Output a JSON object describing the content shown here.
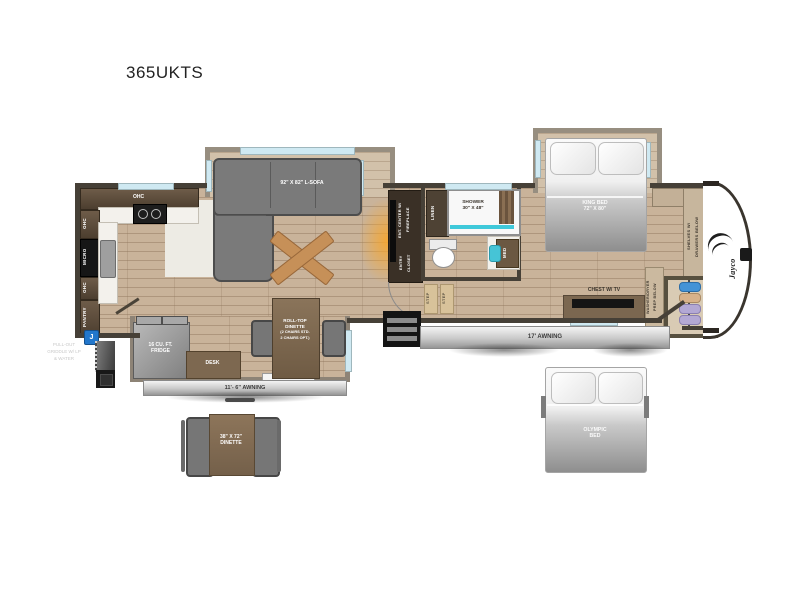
{
  "page": {
    "title": "365UKTS"
  },
  "floorplan": {
    "kitchen": {
      "ohc_top": "OHC",
      "ohc_upper": "OHC",
      "micro": "MICRO",
      "ohc_lower": "OHC",
      "pantry": "PANTRY"
    },
    "living": {
      "sofa": "92\" X 82\" L-SOFA",
      "ent_center_line1": "ENT. CENTER W/",
      "ent_center_line2": "FIREPLACE",
      "entry_closet_line1": "ENTRY",
      "entry_closet_line2": "CLOSET"
    },
    "bath": {
      "linen": "LINEN",
      "shower_line1": "SHOWER",
      "shower_line2": "30\" X 48\"",
      "med": "MED",
      "step": "STEP"
    },
    "bedroom": {
      "king_bed_line1": "KING BED",
      "king_bed_line2": "72\" X 80\"",
      "chest": "CHEST W/ TV",
      "shelves_line1": "SHELVES W/",
      "shelves_line2": "DRAWERS BELOW",
      "washer_line1": "WASHER/DRYER",
      "washer_line2": "PREP BELOW"
    },
    "slide_dinette": {
      "fridge_line1": "16 CU. FT.",
      "fridge_line2": "FRIDGE",
      "desk": "DESK",
      "rolltop_line1": "ROLL-TOP",
      "rolltop_line2": "DINETTE",
      "rolltop_note1": "(2 CHAIRS STD.",
      "rolltop_note2": "2 CHAIRS OPT.)"
    },
    "exterior": {
      "awning_main": "17' AWNING",
      "awning_slide": "11'- 6\" AWNING",
      "griddle_note_line1": "PULL-OUT",
      "griddle_note_line2": "GRIDDLE W/ LP",
      "griddle_note_line3": "& WATER",
      "j_marker": "J",
      "brand": "Jayco"
    },
    "options": {
      "dinette_line1": "38\" X 72\"",
      "dinette_line2": "DINETTE",
      "olympic_line1": "OLYMPIC",
      "olympic_line2": "BED"
    },
    "colors": {
      "wood": "#c9b39a",
      "wall": "#464037",
      "window": "#cfe9f2",
      "shower_teal": "#3fc9da",
      "marker_blue": "#2277cc",
      "hanger_blue": "#4493d6",
      "hanger_tan": "#d8b28a",
      "hanger_lavender": "#b3a8d4"
    }
  }
}
